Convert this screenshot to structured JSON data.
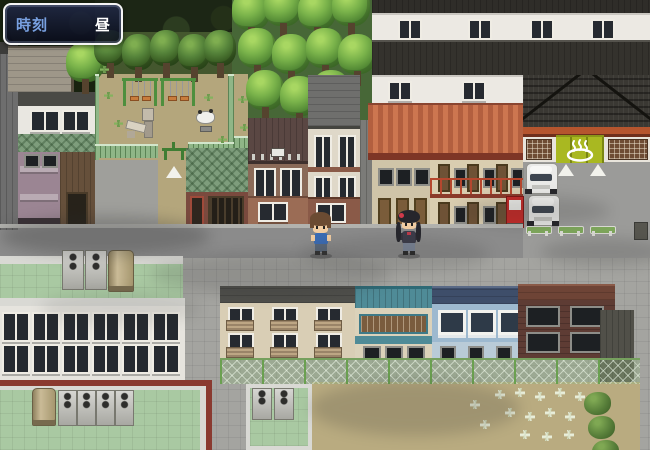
{
  "hud": {
    "time_window": {
      "label": "時刻",
      "value": "昼"
    }
  },
  "scene": {
    "type": "rpg-town-map-daytime",
    "entities": [
      "forest",
      "tree-grove",
      "playground",
      "swing-set",
      "slide",
      "spring-rider",
      "park-fence",
      "park-entrance-lamp",
      "townhouses",
      "white-apartment-block",
      "orange-roof-rowhouse",
      "onsen-building",
      "hot-spring-noren",
      "parked-van",
      "vending-machine",
      "bench",
      "parking-triangle-marker",
      "road",
      "boy-npc",
      "girl-npc",
      "school-building",
      "rooftop-ac-unit",
      "water-tank",
      "beige-apartment",
      "ryokan-building",
      "blue-house",
      "brick-building",
      "chain-link-fence",
      "courtyard",
      "white-grass-tufts",
      "bushes",
      "trash-bin"
    ],
    "colors": {
      "hud_label_blue": "#78a0e0",
      "hud_value_white": "#ffffff",
      "hud_border": "#f5f5f5",
      "hud_background": "#141a32",
      "onsen_noren_green": "#a9b821",
      "hot_spring_mark": "#ffffff",
      "road_gray": "#8b8b8b",
      "rooftop_green": "#a9c9a2",
      "fence_green": "#76a05e",
      "swing_seat_orange": "#c87c3c",
      "vending_machine_red": "#c62a28",
      "tree_green": "#79b24a",
      "yard_tan": "#b9ab80",
      "orange_roof": "#c06a48",
      "school_trim_red": "#8a3a30"
    }
  }
}
